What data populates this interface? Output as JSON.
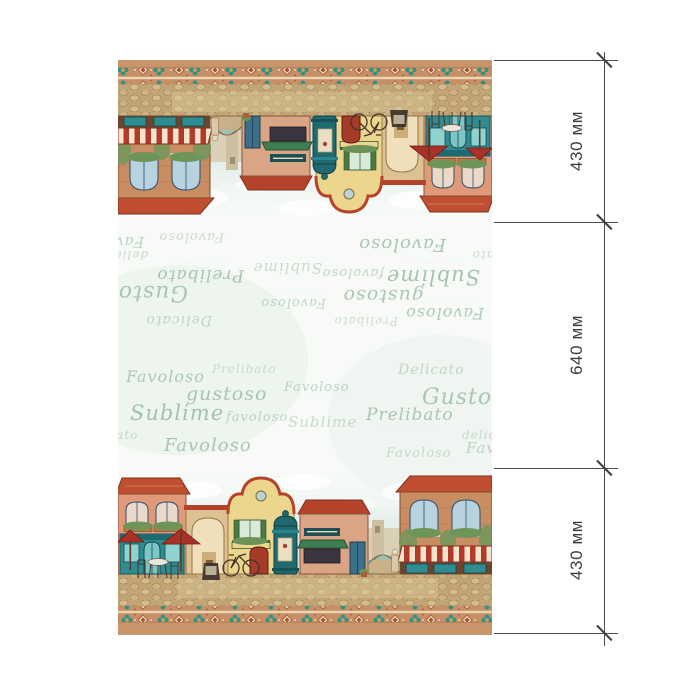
{
  "dimensions": {
    "labels": [
      "430 мм",
      "640 мм",
      "430 мм"
    ],
    "line_color": "#4b4b4b",
    "tick_positions_px": [
      60,
      222,
      468,
      633
    ]
  },
  "fabric": {
    "caption_text": "· · · · · · · · · ·",
    "words_color": "#8fb6a2",
    "words": [
      {
        "t": "Favoloso",
        "x": 8,
        "y": 24,
        "s": 16,
        "o": 0.7,
        "cap": true
      },
      {
        "t": "Prelibato",
        "x": 94,
        "y": 18,
        "s": 12,
        "o": 0.4
      },
      {
        "t": "Delicato",
        "x": 280,
        "y": 18,
        "s": 14,
        "o": 0.5
      },
      {
        "t": "gustoso",
        "x": 68,
        "y": 40,
        "s": 19,
        "o": 0.75
      },
      {
        "t": "Favoloso",
        "x": 166,
        "y": 36,
        "s": 13,
        "o": 0.55,
        "cap": true
      },
      {
        "t": "Gustoso",
        "x": 304,
        "y": 42,
        "s": 22,
        "o": 0.75
      },
      {
        "t": "Sublime",
        "x": 12,
        "y": 58,
        "s": 21,
        "o": 0.8,
        "cap": true
      },
      {
        "t": "favoloso",
        "x": 108,
        "y": 66,
        "s": 13,
        "o": 0.55
      },
      {
        "t": "Sublime",
        "x": 170,
        "y": 70,
        "s": 15,
        "o": 0.45
      },
      {
        "t": "Prelibato",
        "x": 248,
        "y": 62,
        "s": 17,
        "o": 0.75,
        "cap": true
      },
      {
        "t": "delicato",
        "x": 344,
        "y": 84,
        "s": 12,
        "o": 0.45
      },
      {
        "t": "delicato",
        "x": -36,
        "y": 84,
        "s": 12,
        "o": 0.45
      },
      {
        "t": "Favoloso",
        "x": 46,
        "y": 92,
        "s": 18,
        "o": 0.75
      },
      {
        "t": "Favoloso",
        "x": 268,
        "y": 102,
        "s": 13,
        "o": 0.45
      },
      {
        "t": "Favoloso",
        "x": 348,
        "y": 96,
        "s": 15,
        "o": 0.55
      }
    ],
    "palette": {
      "strip_tan": "#c79569",
      "ornament_base": "#c78f66",
      "ornament_teal": "#2f9186",
      "ornament_red": "#a45138",
      "roof_red": "#bf4f30",
      "storefront_teal": "#2e8c92",
      "awning_red": "#b13a2a",
      "awning_cream": "#f2e4cc",
      "facade_pink": "#e09a7a",
      "facade_yellow": "#ecd68e",
      "facade_brick": "#c98d62",
      "column_teal": "#20696f",
      "cobblestone": "#c2a476",
      "sky": "#cfe0d9",
      "umbrella_red": "#a93226"
    }
  }
}
